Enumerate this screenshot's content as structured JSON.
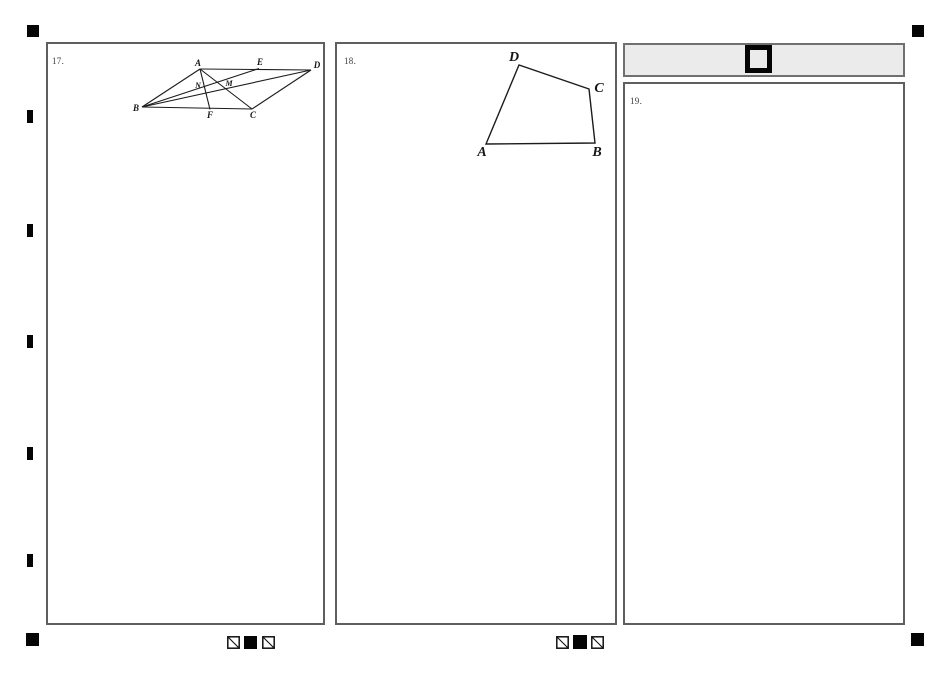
{
  "document": {
    "kind": "scanned answer sheet page"
  },
  "questions": [
    {
      "number_label": "17."
    },
    {
      "number_label": "18."
    },
    {
      "number_label": "19."
    }
  ],
  "figure17": {
    "labels": {
      "A": "A",
      "B": "B",
      "C": "C",
      "D": "D",
      "E": "E",
      "F": "F",
      "N": "N",
      "M": "M"
    }
  },
  "figure18": {
    "labels": {
      "A": "A",
      "B": "B",
      "C": "C",
      "D": "D"
    }
  },
  "colors": {
    "panel_border": "#5f5f5f",
    "header_fill": "#ebebeb",
    "registration_mark": "#050505",
    "figure_line": "#1c1c1c"
  }
}
